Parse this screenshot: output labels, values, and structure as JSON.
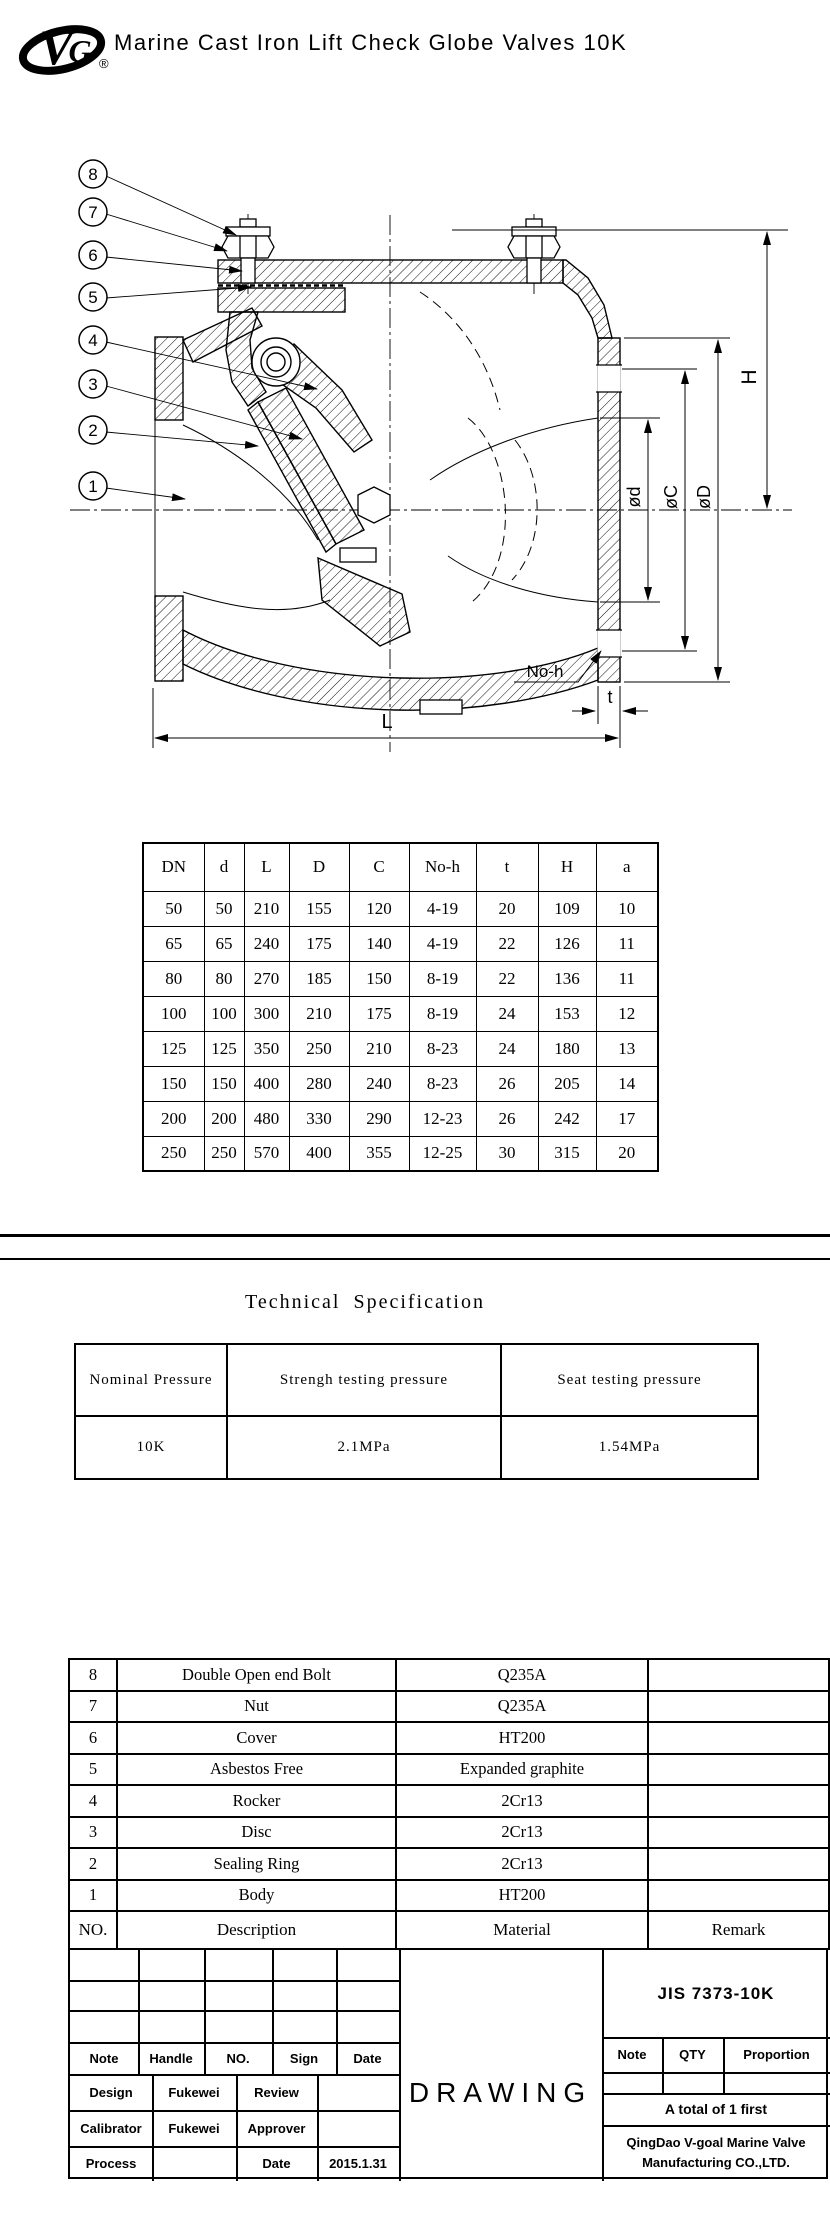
{
  "header": {
    "title": "Marine Cast Iron Lift Check Globe Valves 10K",
    "registered": "®"
  },
  "drawing": {
    "callouts": [
      "8",
      "7",
      "6",
      "5",
      "4",
      "3",
      "2",
      "1"
    ],
    "labels": {
      "H": "H",
      "od": "ød",
      "oC": "øC",
      "oD": "øD",
      "noh": "No-h",
      "t": "t",
      "L": "L"
    }
  },
  "dimension_table": {
    "headers": [
      "DN",
      "d",
      "L",
      "D",
      "C",
      "No-h",
      "t",
      "H",
      "a"
    ],
    "rows": [
      [
        "50",
        "50",
        "210",
        "155",
        "120",
        "4-19",
        "20",
        "109",
        "10"
      ],
      [
        "65",
        "65",
        "240",
        "175",
        "140",
        "4-19",
        "22",
        "126",
        "11"
      ],
      [
        "80",
        "80",
        "270",
        "185",
        "150",
        "8-19",
        "22",
        "136",
        "11"
      ],
      [
        "100",
        "100",
        "300",
        "210",
        "175",
        "8-19",
        "24",
        "153",
        "12"
      ],
      [
        "125",
        "125",
        "350",
        "250",
        "210",
        "8-23",
        "24",
        "180",
        "13"
      ],
      [
        "150",
        "150",
        "400",
        "280",
        "240",
        "8-23",
        "26",
        "205",
        "14"
      ],
      [
        "200",
        "200",
        "480",
        "330",
        "290",
        "12-23",
        "26",
        "242",
        "17"
      ],
      [
        "250",
        "250",
        "570",
        "400",
        "355",
        "12-25",
        "30",
        "315",
        "20"
      ]
    ]
  },
  "tech_spec": {
    "title": "Technical Specification",
    "headers": [
      "Nominal Pressure",
      "Strengh testing pressure",
      "Seat testing pressure"
    ],
    "values": [
      "10K",
      "2.1MPa",
      "1.54MPa"
    ]
  },
  "parts_table": {
    "rows": [
      [
        "8",
        "Double Open end Bolt",
        "Q235A",
        ""
      ],
      [
        "7",
        "Nut",
        "Q235A",
        ""
      ],
      [
        "6",
        "Cover",
        "HT200",
        ""
      ],
      [
        "5",
        "Asbestos Free",
        "Expanded graphite",
        ""
      ],
      [
        "4",
        "Rocker",
        "2Cr13",
        ""
      ],
      [
        "3",
        "Disc",
        "2Cr13",
        ""
      ],
      [
        "2",
        "Sealing Ring",
        "2Cr13",
        ""
      ],
      [
        "1",
        "Body",
        "HT200",
        ""
      ]
    ],
    "footer": [
      "NO.",
      "Description",
      "Material",
      "Remark"
    ]
  },
  "title_block": {
    "left_header": [
      "Note",
      "Handle",
      "NO.",
      "Sign",
      "Date"
    ],
    "sign_rows": {
      "design_label": "Design",
      "design_value": "Fukewei",
      "review_label": "Review",
      "review_value": "",
      "calibrator_label": "Calibrator",
      "calibrator_value": "Fukewei",
      "approver_label": "Approver",
      "approver_value": "",
      "process_label": "Process",
      "process_value": "",
      "date_label": "Date",
      "date_value": "2015.1.31"
    },
    "drawing_label": "DRAWING",
    "standard": "JIS 7373-10K",
    "qty_header": [
      "Note",
      "QTY",
      "Proportion"
    ],
    "total_note": "A total of 1 first",
    "company": [
      "QingDao V-goal Marine Valve",
      "Manufacturing CO.,LTD."
    ]
  }
}
